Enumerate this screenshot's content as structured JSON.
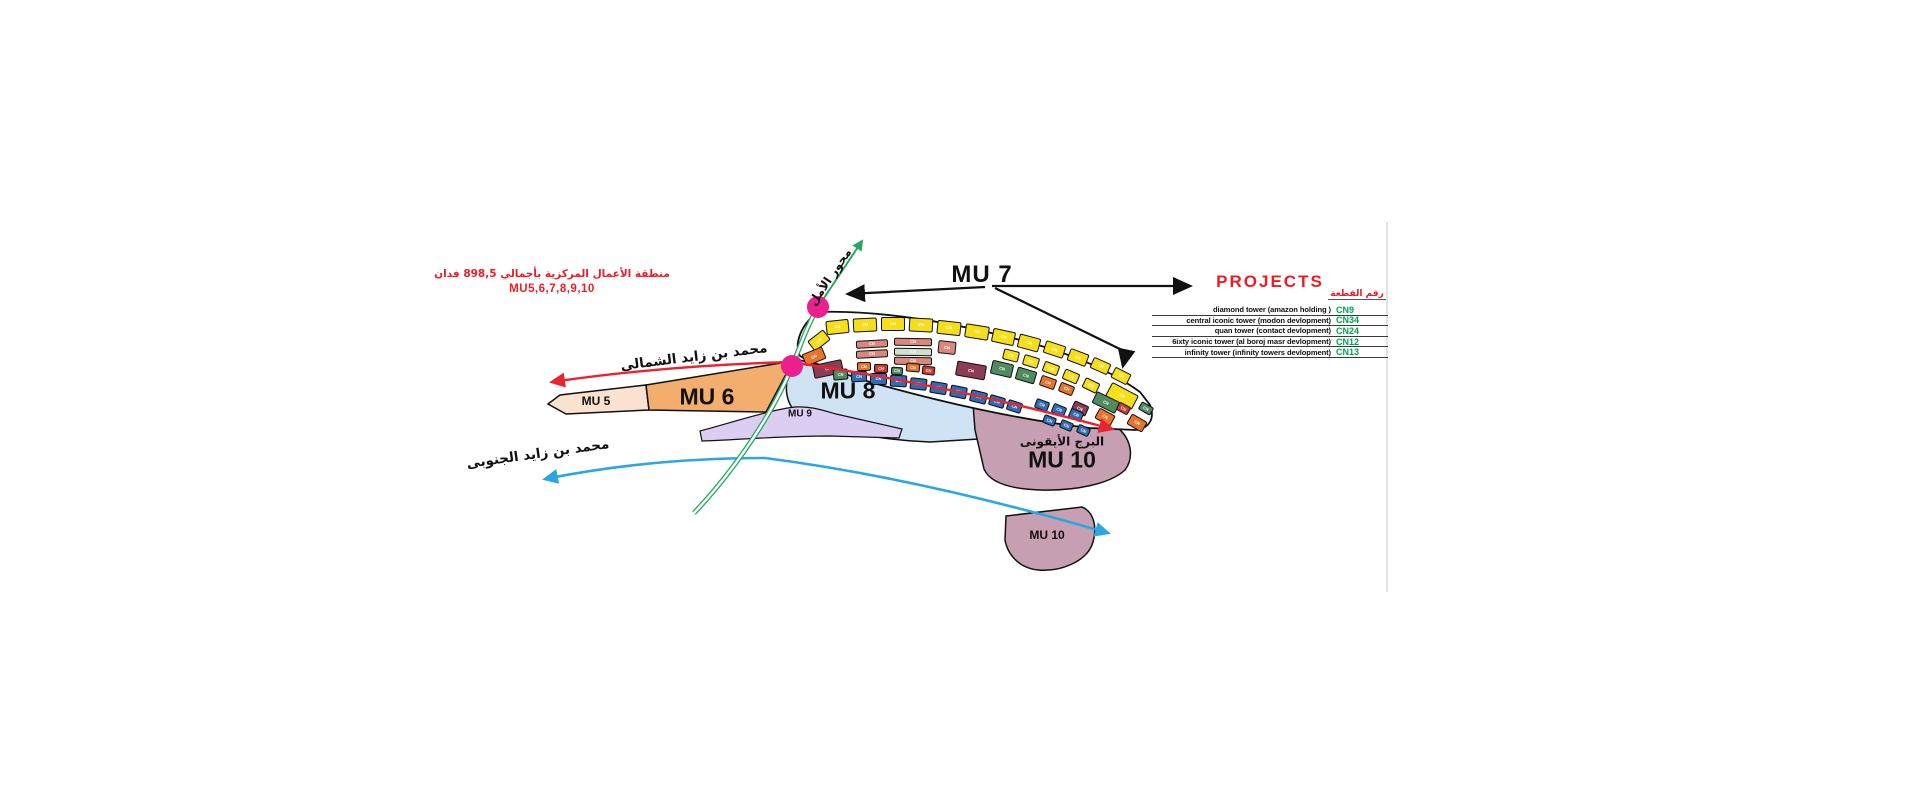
{
  "caption": {
    "line1": "منطقة الأعمال المركزية بأجمالي 898,5 فدان",
    "line2": "MU5,6,7,8,9,10",
    "color": "#ed1c24"
  },
  "axis": {
    "label": "محور الأمل",
    "color": "#27a85f"
  },
  "roads": {
    "north": {
      "label": "محمد بن زايد الشمالى",
      "color": "#ea2330"
    },
    "south": {
      "label": "محمد بن زايد الجنوبى",
      "color": "#2ba6e0"
    }
  },
  "zones": {
    "mu5": {
      "label": "MU 5",
      "color": "#fbe2d0"
    },
    "mu6": {
      "label": "MU 6",
      "color": "#f3ad6d"
    },
    "mu7": {
      "label": "MU 7"
    },
    "mu8": {
      "label": "MU 8",
      "color": "#cfe3f5"
    },
    "mu9": {
      "label": "MU 9",
      "color": "#dccdf2"
    },
    "mu10": {
      "label_ar": "البرج الأيقونى",
      "label": "MU 10",
      "color": "#c79fb2"
    },
    "mu10_south": {
      "label": "MU 10"
    }
  },
  "projects": {
    "title": "PROJECTS",
    "title_color": "#ed1c24",
    "col_header": "رقم القطعة",
    "code_color": "#00a553",
    "rows": [
      {
        "name": "diamond tower (amazon holding )",
        "code": "CN9"
      },
      {
        "name": "central iconic tower (modon devlopment)",
        "code": "CN34"
      },
      {
        "name": "quan tower (contact devlopment)",
        "code": "CN24"
      },
      {
        "name": "6ixty iconic tower (al boroj masr devlopment)",
        "code": "CN12"
      },
      {
        "name": "infinity tower (infinity towers devlopment)",
        "code": "CN13"
      }
    ]
  },
  "markers": {
    "color": "#ec1f8e"
  },
  "palette": {
    "yellow": "#f6de18",
    "salmon": "#d9897c",
    "orange": "#e8742b",
    "maroon": "#8c3d55",
    "green": "#4f8a60",
    "blue": "#2e6cb5",
    "red": "#cf3a33",
    "lightgreen": "#cfe0cf"
  },
  "cluster": {
    "label_prefix": "CN",
    "plots": [
      [
        826,
        320,
        23,
        14,
        -6,
        "yellow"
      ],
      [
        853,
        318,
        24,
        14,
        -3,
        "yellow"
      ],
      [
        881,
        317,
        24,
        14,
        0,
        "yellow"
      ],
      [
        909,
        318,
        24,
        14,
        3,
        "yellow"
      ],
      [
        937,
        321,
        24,
        14,
        6,
        "yellow"
      ],
      [
        965,
        325,
        24,
        14,
        9,
        "yellow"
      ],
      [
        992,
        330,
        23,
        14,
        12,
        "yellow"
      ],
      [
        1018,
        336,
        22,
        14,
        15,
        "yellow"
      ],
      [
        1044,
        343,
        21,
        13,
        18,
        "yellow"
      ],
      [
        1068,
        351,
        20,
        13,
        21,
        "yellow"
      ],
      [
        1091,
        360,
        19,
        12,
        24,
        "yellow"
      ],
      [
        1112,
        370,
        18,
        12,
        27,
        "yellow"
      ],
      [
        1003,
        350,
        16,
        11,
        14,
        "yellow"
      ],
      [
        1023,
        356,
        16,
        11,
        17,
        "yellow"
      ],
      [
        1043,
        363,
        16,
        11,
        20,
        "yellow"
      ],
      [
        1063,
        371,
        16,
        11,
        23,
        "yellow"
      ],
      [
        1083,
        380,
        16,
        11,
        26,
        "yellow"
      ],
      [
        1107,
        388,
        30,
        16,
        28,
        "yellow"
      ],
      [
        1139,
        404,
        14,
        9,
        30,
        "green"
      ],
      [
        809,
        334,
        20,
        13,
        -38,
        "yellow"
      ],
      [
        803,
        350,
        22,
        13,
        -22,
        "orange"
      ],
      [
        813,
        362,
        30,
        14,
        -12,
        "maroon"
      ],
      [
        856,
        340,
        32,
        8,
        -3,
        "salmon"
      ],
      [
        856,
        350,
        32,
        8,
        -3,
        "salmon"
      ],
      [
        894,
        338,
        38,
        8,
        1,
        "salmon"
      ],
      [
        894,
        348,
        38,
        8,
        1,
        "lightgreen"
      ],
      [
        894,
        357,
        38,
        8,
        1,
        "salmon"
      ],
      [
        938,
        341,
        18,
        13,
        6,
        "salmon"
      ],
      [
        857,
        362,
        14,
        9,
        -2,
        "orange"
      ],
      [
        874,
        364,
        14,
        9,
        1,
        "red"
      ],
      [
        891,
        367,
        12,
        8,
        3,
        "green"
      ],
      [
        906,
        363,
        14,
        9,
        5,
        "orange"
      ],
      [
        922,
        366,
        13,
        9,
        7,
        "red"
      ],
      [
        956,
        363,
        30,
        15,
        10,
        "maroon"
      ],
      [
        991,
        362,
        22,
        14,
        13,
        "green"
      ],
      [
        1016,
        369,
        20,
        13,
        16,
        "green"
      ],
      [
        1040,
        377,
        16,
        11,
        19,
        "orange"
      ],
      [
        1059,
        384,
        15,
        10,
        22,
        "orange"
      ],
      [
        1093,
        396,
        26,
        13,
        26,
        "green"
      ],
      [
        1072,
        403,
        16,
        11,
        24,
        "maroon"
      ],
      [
        1096,
        411,
        18,
        12,
        28,
        "orange"
      ],
      [
        1117,
        404,
        13,
        9,
        28,
        "red"
      ],
      [
        833,
        369,
        15,
        11,
        -5,
        "green"
      ],
      [
        851,
        371,
        16,
        11,
        -2,
        "blue"
      ],
      [
        870,
        373,
        17,
        12,
        0,
        "blue"
      ],
      [
        890,
        375,
        17,
        12,
        3,
        "blue"
      ],
      [
        910,
        378,
        17,
        12,
        6,
        "blue"
      ],
      [
        930,
        382,
        17,
        12,
        9,
        "blue"
      ],
      [
        950,
        386,
        17,
        12,
        11,
        "blue"
      ],
      [
        970,
        391,
        17,
        12,
        14,
        "blue"
      ],
      [
        989,
        396,
        16,
        11,
        16,
        "blue"
      ],
      [
        1007,
        401,
        15,
        11,
        18,
        "blue"
      ],
      [
        1035,
        400,
        14,
        10,
        20,
        "blue"
      ],
      [
        1052,
        405,
        14,
        10,
        22,
        "blue"
      ],
      [
        1069,
        410,
        14,
        10,
        24,
        "blue"
      ],
      [
        1043,
        416,
        13,
        9,
        21,
        "blue"
      ],
      [
        1060,
        421,
        13,
        9,
        23,
        "blue"
      ],
      [
        1077,
        426,
        13,
        9,
        25,
        "blue"
      ],
      [
        1128,
        417,
        18,
        12,
        30,
        "orange"
      ]
    ]
  }
}
